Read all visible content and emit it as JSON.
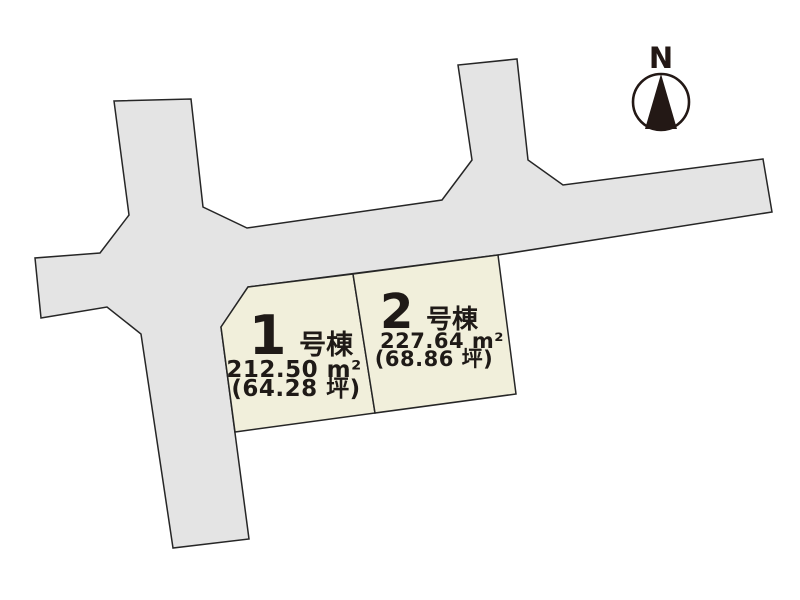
{
  "colors": {
    "background": "#ffffff",
    "road_fill": "#e4e4e4",
    "lot_fill": "#f1efdb",
    "outline": "#262626",
    "text": "#1f1a17",
    "compass": "#231815"
  },
  "compass": {
    "label": "N"
  },
  "lots": [
    {
      "name": "1号棟",
      "number": "1",
      "suffix": "号棟",
      "area": "212.50 m²",
      "area_tsubo": "(64.28 坪)"
    },
    {
      "name": "2号棟",
      "number": "2",
      "suffix": "号棟",
      "area": "227.64 m²",
      "area_tsubo": "(68.86 坪)"
    }
  ]
}
